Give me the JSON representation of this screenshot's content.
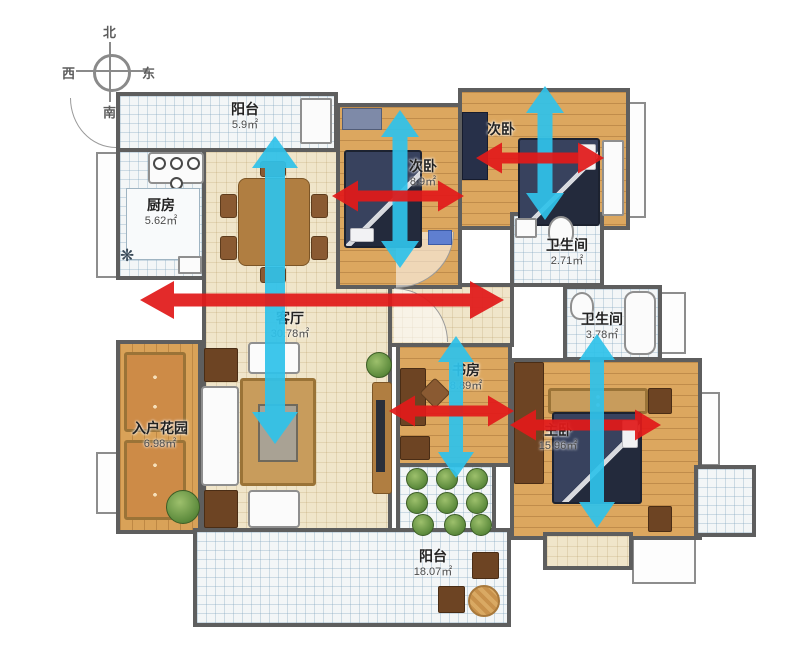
{
  "compass": {
    "north": "北",
    "south": "南",
    "west": "西",
    "east": "东"
  },
  "rooms": {
    "balcony_top": {
      "name": "阳台",
      "area": "5.9㎡"
    },
    "kitchen": {
      "name": "厨房",
      "area": "5.62㎡"
    },
    "bedroom2_mid": {
      "name": "次卧",
      "area": "8.9㎡"
    },
    "bedroom2_right": {
      "name": "次卧",
      "area": ""
    },
    "bath_small": {
      "name": "卫生间",
      "area": "2.71㎡"
    },
    "bath_big": {
      "name": "卫生间",
      "area": "3.78㎡"
    },
    "living": {
      "name": "客厅",
      "area": "30.78㎡"
    },
    "study": {
      "name": "书房",
      "area": "8.89㎡"
    },
    "master": {
      "name": "主卧",
      "area": "15.96㎡"
    },
    "foyer_garden": {
      "name": "入户花园",
      "area": "6.98㎡"
    },
    "balcony_bottom": {
      "name": "阳台",
      "area": "18.07㎡"
    }
  },
  "colors": {
    "arrow_red": "#e11a1a",
    "arrow_cyan": "#2fc2ea",
    "wall": "#5e5e5e"
  },
  "arrows": [
    {
      "name": "balcony-to-living-vertical",
      "color": "arrow_cyan",
      "x1": 275,
      "y1": 136,
      "x2": 275,
      "y2": 444,
      "bw": 20,
      "hw": 46,
      "hl": 32
    },
    {
      "name": "bedroom2-mid-vertical",
      "color": "arrow_cyan",
      "x1": 400,
      "y1": 110,
      "x2": 400,
      "y2": 268,
      "bw": 15,
      "hw": 38,
      "hl": 27
    },
    {
      "name": "bedroom2-mid-horizontal",
      "color": "arrow_red",
      "x1": 332,
      "y1": 196,
      "x2": 464,
      "y2": 196,
      "bw": 11,
      "hw": 31,
      "hl": 26
    },
    {
      "name": "bedroom2-right-vertical",
      "color": "arrow_cyan",
      "x1": 545,
      "y1": 86,
      "x2": 545,
      "y2": 220,
      "bw": 15,
      "hw": 38,
      "hl": 27
    },
    {
      "name": "bedroom2-right-horizontal",
      "color": "arrow_red",
      "x1": 476,
      "y1": 158,
      "x2": 604,
      "y2": 158,
      "bw": 11,
      "hw": 31,
      "hl": 26
    },
    {
      "name": "living-cross-horizontal",
      "color": "arrow_red",
      "x1": 140,
      "y1": 300,
      "x2": 504,
      "y2": 300,
      "bw": 13,
      "hw": 38,
      "hl": 34
    },
    {
      "name": "study-vertical",
      "color": "arrow_cyan",
      "x1": 456,
      "y1": 336,
      "x2": 456,
      "y2": 478,
      "bw": 14,
      "hw": 36,
      "hl": 26
    },
    {
      "name": "study-horizontal",
      "color": "arrow_red",
      "x1": 389,
      "y1": 411,
      "x2": 514,
      "y2": 411,
      "bw": 11,
      "hw": 31,
      "hl": 26
    },
    {
      "name": "master-horizontal",
      "color": "arrow_red",
      "x1": 510,
      "y1": 425,
      "x2": 661,
      "y2": 425,
      "bw": 11,
      "hw": 31,
      "hl": 26
    },
    {
      "name": "master-vertical",
      "color": "arrow_cyan",
      "x1": 597,
      "y1": 334,
      "x2": 597,
      "y2": 528,
      "bw": 14,
      "hw": 36,
      "hl": 26
    }
  ]
}
